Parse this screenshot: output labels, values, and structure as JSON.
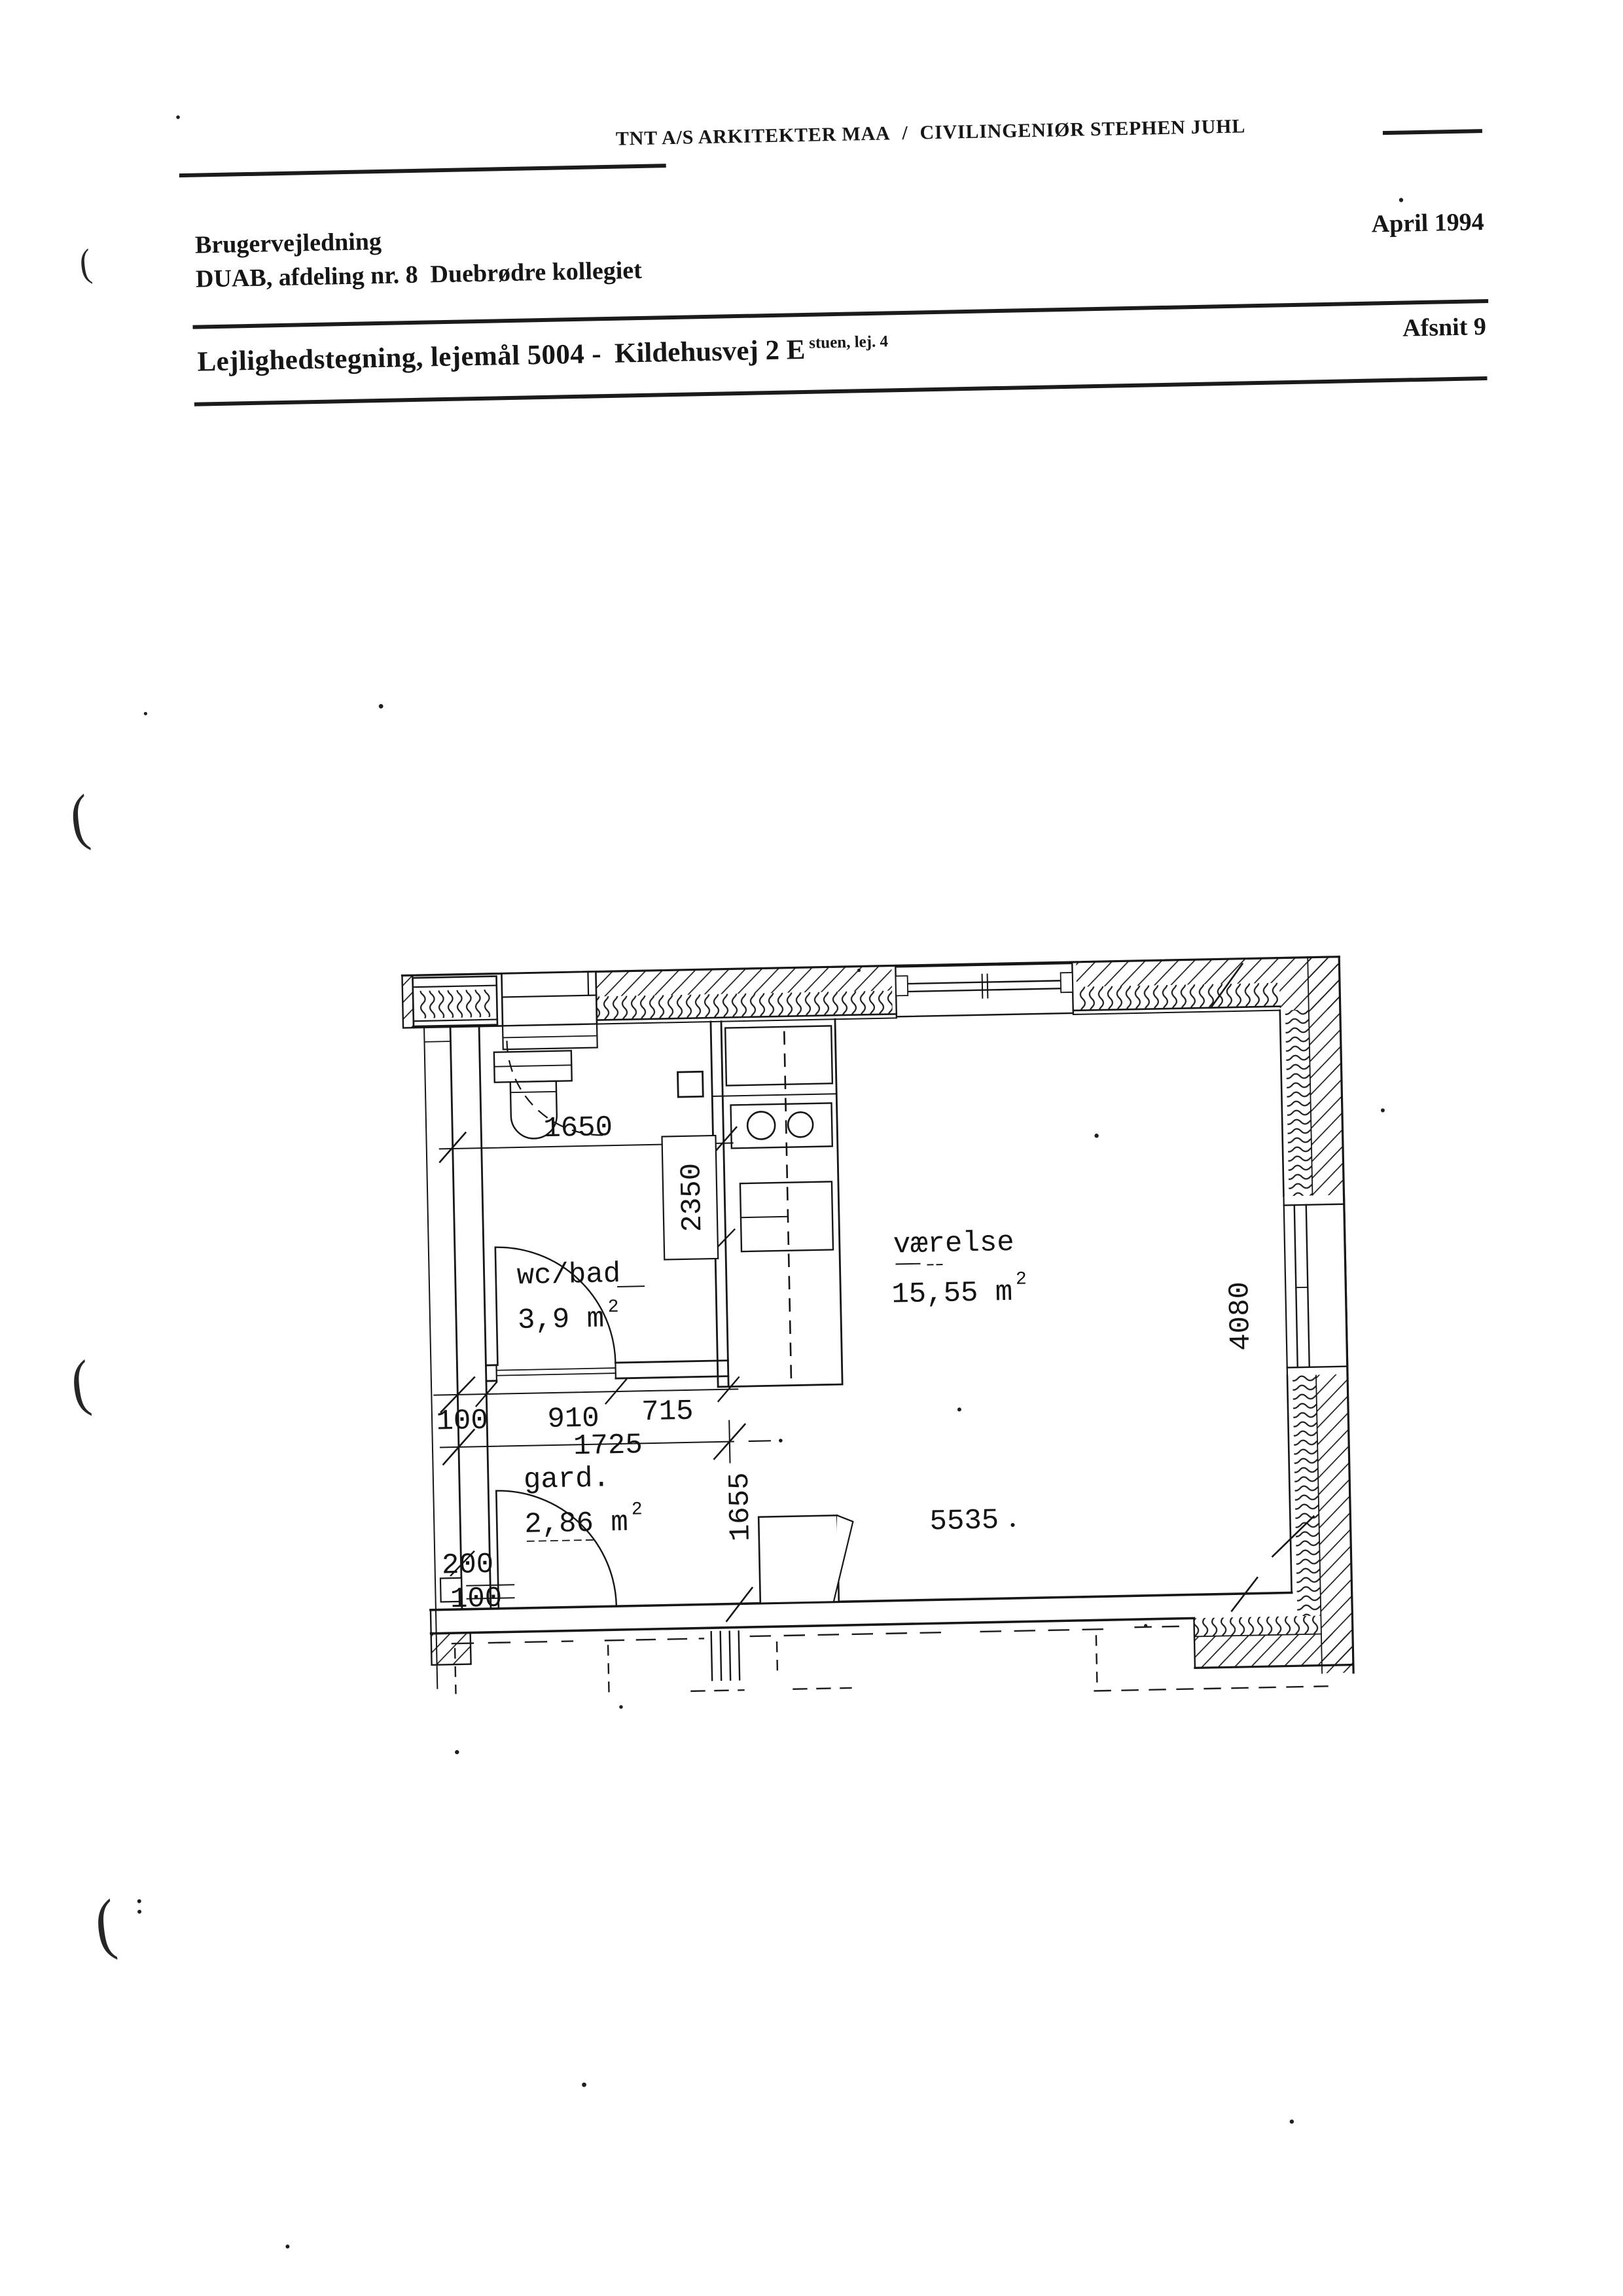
{
  "letterhead": {
    "firm": "TNT A/S ARKITEKTER MAA",
    "separator": "/",
    "engineer": "CIVILINGENIØR STEPHEN JUHL"
  },
  "header": {
    "doc_type": "Brugervejledning",
    "department": "DUAB, afdeling nr. 8  Duebrødre kollegiet",
    "date": "April 1994",
    "title": "Lejlighedstegning, lejemål 5004 -",
    "address": "Kildehusvej 2 E",
    "address_note": "stuen, lej. 4",
    "section": "Afsnit 9"
  },
  "plan": {
    "rooms": [
      {
        "name": "wc/bad",
        "area": "3,9 m",
        "area_sup": "2"
      },
      {
        "name": "værelse",
        "area": "15,55 m",
        "area_sup": "2"
      },
      {
        "name": "gard.",
        "area": "2,86 m",
        "area_sup": "2"
      }
    ],
    "dims": {
      "d1650": "1650",
      "d2350": "2350",
      "d100a": "100",
      "d910": "910",
      "d715": "715",
      "d1725": "1725",
      "d200": "200",
      "d100b": "100",
      "d1655": "1655",
      "d5535": "5535",
      "d4080": "4080"
    }
  },
  "artifacts": {
    "margin_marks": [
      "(",
      "(",
      "(",
      "("
    ]
  }
}
